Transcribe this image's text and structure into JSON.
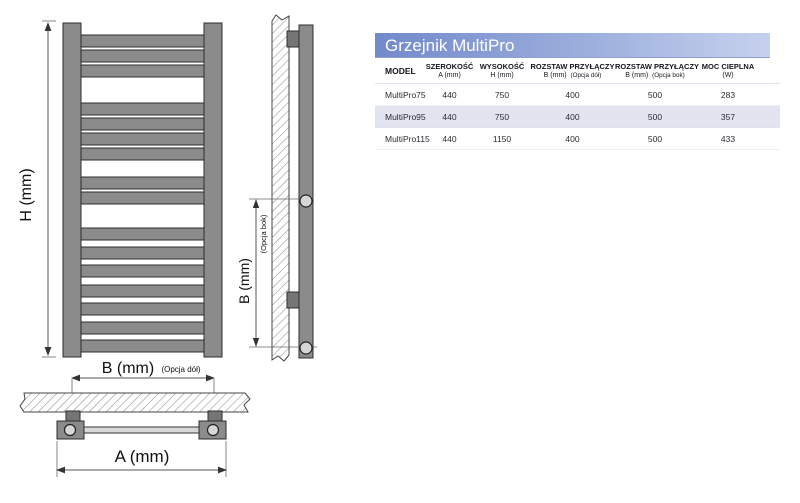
{
  "drawing": {
    "h_label": "H (mm)",
    "b_bottom_label": "B (mm)",
    "b_bottom_note": "(Opcja dół)",
    "b_side_label": "B (mm)",
    "b_side_note": "(Opcja bok)",
    "a_label": "A (mm)"
  },
  "table": {
    "title": "Grzejnik MultiPro",
    "header": {
      "model": "MODEL",
      "width": "SZEROKOŚĆ",
      "width_sub": "A (mm)",
      "height": "WYSOKOŚĆ",
      "height_sub": "H (mm)",
      "spacing_bottom": "ROZSTAW PRZYŁĄCZY",
      "spacing_bottom_sub": "B (mm)",
      "spacing_bottom_note": "(Opcja dół)",
      "spacing_side": "ROZSTAW PRZYŁĄCZY",
      "spacing_side_sub": "B (mm)",
      "spacing_side_note": "(Opcja bok)",
      "power": "MOC CIEPLNA",
      "power_sub": "(W)"
    },
    "rows": [
      {
        "model": "MultiPro75",
        "width": "440",
        "height": "750",
        "spacing_bottom": "400",
        "spacing_side": "500",
        "power": "283"
      },
      {
        "model": "MultiPro95",
        "width": "440",
        "height": "750",
        "spacing_bottom": "400",
        "spacing_side": "500",
        "power": "357"
      },
      {
        "model": "MultiPro115",
        "width": "440",
        "height": "1150",
        "spacing_bottom": "400",
        "spacing_side": "500",
        "power": "433"
      }
    ]
  },
  "colors": {
    "title_gradient_start": "#7289cb",
    "title_gradient_end": "#c6d1ee",
    "row_alt_bg": "#e2e5f0",
    "radiator_gray": "#8b8b8b"
  }
}
